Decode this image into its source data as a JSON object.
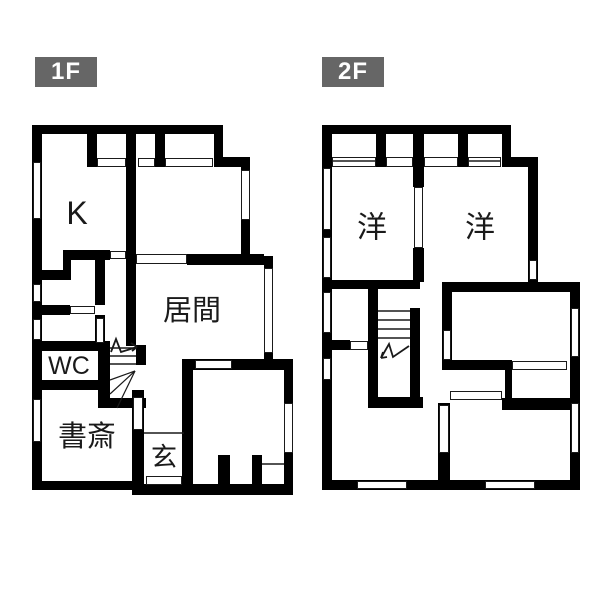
{
  "page": {
    "background": "#ffffff",
    "wall_color": "#000000",
    "line_color": "#1a1a1a",
    "tag_bg": "#666666",
    "tag_text_color": "#ffffff"
  },
  "floors": [
    {
      "id": "1f",
      "label": "1F",
      "tag_box": {
        "x": 35,
        "y": 57,
        "w": 62,
        "h": 30
      },
      "rooms": [
        {
          "name": "kitchen",
          "label": "K",
          "x": 77,
          "y": 213,
          "size": 32
        },
        {
          "name": "living-room",
          "label": "居間",
          "x": 192,
          "y": 311,
          "size": 29
        },
        {
          "name": "toilet",
          "label": "WC",
          "x": 69,
          "y": 366,
          "size": 25
        },
        {
          "name": "study",
          "label": "書斎",
          "x": 87,
          "y": 437,
          "size": 29
        },
        {
          "name": "entrance",
          "label": "玄",
          "x": 164,
          "y": 457,
          "size": 26
        }
      ],
      "walls": [
        [
          32,
          125,
          191,
          9
        ],
        [
          214,
          125,
          9,
          42
        ],
        [
          214,
          157,
          36,
          10
        ],
        [
          241,
          157,
          9,
          108
        ],
        [
          241,
          256,
          32,
          9
        ],
        [
          264,
          256,
          9,
          112
        ],
        [
          264,
          359,
          29,
          11
        ],
        [
          284,
          359,
          9,
          136
        ],
        [
          135,
          484,
          158,
          11
        ],
        [
          32,
          481,
          106,
          9
        ],
        [
          32,
          125,
          10,
          356
        ],
        [
          87,
          134,
          10,
          33
        ],
        [
          155,
          134,
          10,
          33
        ],
        [
          126,
          134,
          10,
          212
        ],
        [
          63,
          250,
          47,
          10
        ],
        [
          63,
          250,
          8,
          30
        ],
        [
          32,
          270,
          39,
          10
        ],
        [
          95,
          260,
          10,
          45
        ],
        [
          32,
          305,
          38,
          10
        ],
        [
          95,
          315,
          10,
          31
        ],
        [
          32,
          341,
          78,
          10
        ],
        [
          98,
          341,
          12,
          67
        ],
        [
          32,
          380,
          68,
          10
        ],
        [
          132,
          390,
          12,
          105
        ],
        [
          98,
          398,
          48,
          10
        ],
        [
          136,
          345,
          10,
          20
        ],
        [
          182,
          359,
          111,
          11
        ],
        [
          182,
          359,
          11,
          136
        ],
        [
          187,
          254,
          77,
          11
        ],
        [
          218,
          455,
          12,
          31
        ],
        [
          252,
          455,
          10,
          31
        ]
      ],
      "windows": [
        [
          33,
          162,
          8,
          57
        ],
        [
          33,
          284,
          8,
          18
        ],
        [
          33,
          319,
          8,
          21
        ],
        [
          33,
          399,
          8,
          43
        ],
        [
          97,
          158,
          29,
          9
        ],
        [
          138,
          158,
          17,
          9
        ],
        [
          165,
          158,
          48,
          9
        ],
        [
          110,
          251,
          16,
          8
        ],
        [
          70,
          306,
          25,
          8
        ],
        [
          96,
          318,
          8,
          25
        ],
        [
          136,
          254,
          51,
          10
        ],
        [
          195,
          360,
          37,
          9
        ],
        [
          241,
          170,
          9,
          50
        ],
        [
          264,
          268,
          9,
          85
        ],
        [
          284,
          403,
          9,
          50
        ],
        [
          133,
          397,
          10,
          33
        ],
        [
          146,
          476,
          36,
          9
        ]
      ],
      "thin_lines": [
        [
          144,
          433,
          184,
          433
        ],
        [
          262,
          464,
          284,
          464
        ]
      ],
      "stairs": {
        "treads": {
          "x1": 110,
          "x2": 136,
          "ys": [
            348,
            356,
            364
          ]
        },
        "winders": [
          [
            135,
            371,
            110,
            380
          ],
          [
            135,
            371,
            110,
            394
          ],
          [
            135,
            371,
            117,
            408
          ]
        ],
        "arrow": [
          [
            111,
            352
          ],
          [
            116,
            339
          ],
          [
            121,
            352
          ],
          [
            137,
            347
          ]
        ],
        "arrow_head": [
          [
            137,
            347,
            131,
            343
          ],
          [
            137,
            347,
            132,
            351
          ]
        ]
      }
    },
    {
      "id": "2f",
      "label": "2F",
      "tag_box": {
        "x": 322,
        "y": 57,
        "w": 62,
        "h": 30
      },
      "rooms": [
        {
          "name": "western-room-1",
          "label": "洋",
          "x": 372,
          "y": 228,
          "size": 30
        },
        {
          "name": "western-room-2",
          "label": "洋",
          "x": 480,
          "y": 228,
          "size": 30
        }
      ],
      "walls": [
        [
          322,
          125,
          189,
          9
        ],
        [
          502,
          125,
          9,
          42
        ],
        [
          502,
          157,
          36,
          10
        ],
        [
          528,
          157,
          10,
          135
        ],
        [
          442,
          282,
          138,
          10
        ],
        [
          570,
          282,
          10,
          208
        ],
        [
          322,
          480,
          258,
          10
        ],
        [
          322,
          125,
          10,
          365
        ],
        [
          376,
          134,
          10,
          33
        ],
        [
          413,
          134,
          11,
          33
        ],
        [
          458,
          134,
          10,
          33
        ],
        [
          413,
          167,
          11,
          20
        ],
        [
          413,
          248,
          11,
          34
        ],
        [
          332,
          280,
          88,
          9
        ],
        [
          368,
          289,
          10,
          119
        ],
        [
          410,
          308,
          10,
          89
        ],
        [
          368,
          397,
          55,
          11
        ],
        [
          322,
          340,
          28,
          10
        ],
        [
          438,
          403,
          12,
          77
        ],
        [
          442,
          292,
          10,
          68
        ],
        [
          442,
          360,
          63,
          10
        ],
        [
          505,
          360,
          7,
          40
        ],
        [
          502,
          398,
          68,
          12
        ]
      ],
      "windows": [
        [
          323,
          168,
          8,
          62
        ],
        [
          323,
          237,
          8,
          41
        ],
        [
          323,
          292,
          8,
          41
        ],
        [
          323,
          358,
          8,
          22
        ],
        [
          332,
          157,
          44,
          10
        ],
        [
          386,
          157,
          27,
          10
        ],
        [
          424,
          157,
          34,
          10
        ],
        [
          468,
          157,
          33,
          10
        ],
        [
          414,
          187,
          9,
          61
        ],
        [
          529,
          260,
          8,
          20
        ],
        [
          350,
          341,
          18,
          9
        ],
        [
          443,
          330,
          8,
          30
        ],
        [
          571,
          308,
          8,
          49
        ],
        [
          571,
          403,
          8,
          50
        ],
        [
          512,
          361,
          55,
          9
        ],
        [
          450,
          391,
          52,
          9
        ],
        [
          439,
          405,
          10,
          48
        ],
        [
          357,
          481,
          50,
          8
        ],
        [
          485,
          481,
          50,
          8
        ]
      ],
      "thin_lines": [
        [
          333,
          161,
          375,
          161
        ],
        [
          469,
          161,
          500,
          161
        ]
      ],
      "stairs": {
        "treads": {
          "x1": 378,
          "x2": 410,
          "ys": [
            311,
            320,
            329,
            338
          ]
        },
        "winders": [],
        "arrow": [
          [
            381,
            358
          ],
          [
            389,
            344
          ],
          [
            393,
            357
          ],
          [
            409,
            346
          ]
        ],
        "arrow_head": [
          [
            381,
            358,
            387,
            357
          ],
          [
            381,
            358,
            383,
            352
          ]
        ]
      }
    }
  ]
}
